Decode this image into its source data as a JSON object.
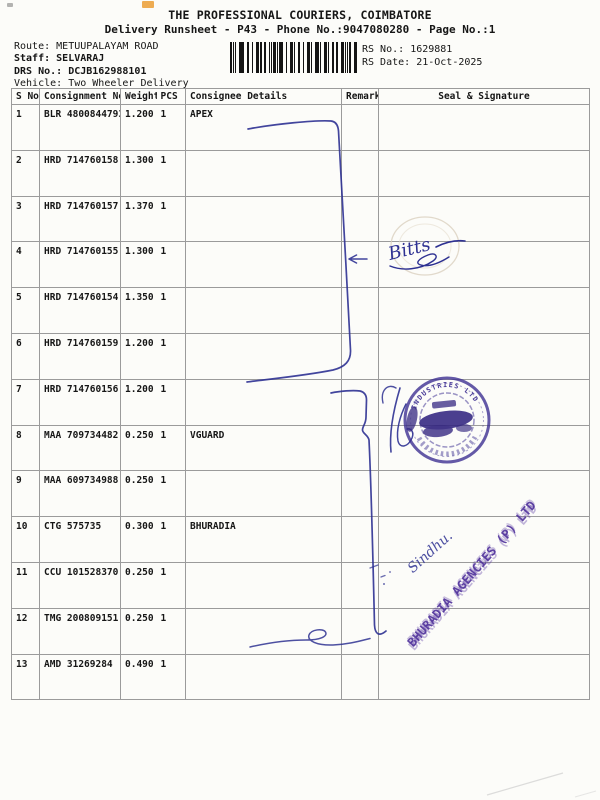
{
  "header": {
    "title": "THE PROFESSIONAL COURIERS, COIMBATORE",
    "subtitle": "Delivery Runsheet - P43 - Phone No.:9047080280 - Page No.:1",
    "route_label": "Route:",
    "route_value": "METUUPALAYAM ROAD",
    "staff_label": "Staff:",
    "staff_value": "SELVARAJ",
    "drs_label": "DRS No.:",
    "drs_value": "DCJB162988101",
    "vehicle_label": "Vehicle:",
    "vehicle_value": "Two Wheeler Delivery",
    "rs_no_label": "RS No.:",
    "rs_no_value": "1629881",
    "rs_date_label": "RS Date:",
    "rs_date_value": "21-Oct-2025"
  },
  "table": {
    "columns": [
      "S No",
      "Consignment No",
      "Weight",
      "PCS",
      "Consignee Details",
      "Remarks",
      "Seal & Signature"
    ],
    "rows": [
      {
        "sno": "1",
        "consignment": "BLR 4800844793",
        "weight": "1.200",
        "pcs": "1",
        "consignee": "APEX"
      },
      {
        "sno": "2",
        "consignment": "HRD 714760158",
        "weight": "1.300",
        "pcs": "1",
        "consignee": ""
      },
      {
        "sno": "3",
        "consignment": "HRD 714760157",
        "weight": "1.370",
        "pcs": "1",
        "consignee": ""
      },
      {
        "sno": "4",
        "consignment": "HRD 714760155",
        "weight": "1.300",
        "pcs": "1",
        "consignee": ""
      },
      {
        "sno": "5",
        "consignment": "HRD 714760154",
        "weight": "1.350",
        "pcs": "1",
        "consignee": ""
      },
      {
        "sno": "6",
        "consignment": "HRD 714760159",
        "weight": "1.200",
        "pcs": "1",
        "consignee": ""
      },
      {
        "sno": "7",
        "consignment": "HRD 714760156",
        "weight": "1.200",
        "pcs": "1",
        "consignee": ""
      },
      {
        "sno": "8",
        "consignment": "MAA 709734482",
        "weight": "0.250",
        "pcs": "1",
        "consignee": "VGUARD"
      },
      {
        "sno": "9",
        "consignment": "MAA 609734988",
        "weight": "0.250",
        "pcs": "1",
        "consignee": ""
      },
      {
        "sno": "10",
        "consignment": "CTG 575735",
        "weight": "0.300",
        "pcs": "1",
        "consignee": "BHURADIA"
      },
      {
        "sno": "11",
        "consignment": "CCU 101528370",
        "weight": "0.250",
        "pcs": "1",
        "consignee": ""
      },
      {
        "sno": "12",
        "consignment": "TMG 200809151",
        "weight": "0.250",
        "pcs": "1",
        "consignee": ""
      },
      {
        "sno": "13",
        "consignment": "AMD 31269284",
        "weight": "0.490",
        "pcs": "1",
        "consignee": ""
      }
    ]
  },
  "annotations": {
    "signature_bitts": "Bitts",
    "signature_sindhu": "Sindhu.",
    "round_stamp_ring_text": "INDUSTRIES LTD",
    "diagonal_stamp_text": "BHURADIA AGENCIES (P) LTD",
    "ink_color": "#2e3192",
    "round_stamp_color": "#3a2b90",
    "diagonal_stamp_color": "#5231a0"
  }
}
